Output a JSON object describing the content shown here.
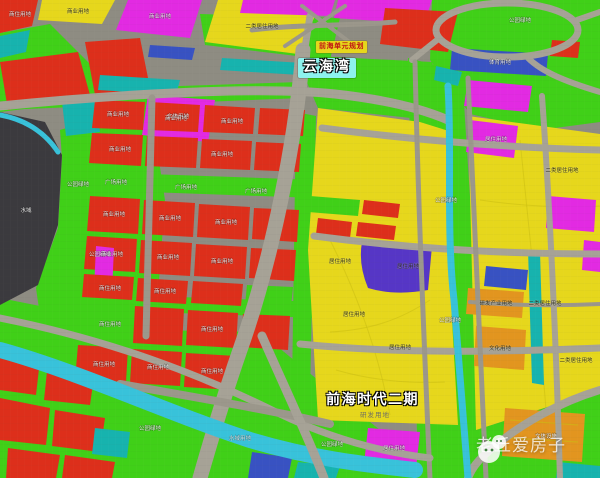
{
  "map": {
    "region": "前海片区规划示意图",
    "labels": {
      "planning_badge": "前海单元规划",
      "bay": "云海湾",
      "phase": "前海时代二期",
      "phase_sub": "研发用地"
    },
    "watermark": {
      "text": "老丘爱房子",
      "icon": "house-mascot-icon"
    },
    "colors": {
      "residential": "#e6d71c",
      "commercial": "#dd2f1b",
      "park": "#40d018",
      "mixed": "#e22ae2",
      "public": "#17b3ae",
      "civic": "#3852c2",
      "special": "#5636c6",
      "industry": "#e2951f",
      "river": "#38c2da",
      "sea": "#3b3a3e",
      "road": "#a6a296"
    },
    "zone_labels": [
      {
        "t": "商住用地",
        "x": 20,
        "y": 16,
        "c": "w"
      },
      {
        "t": "商业用地",
        "x": 78,
        "y": 13,
        "c": "k"
      },
      {
        "t": "商业用地",
        "x": 160,
        "y": 18,
        "c": "w"
      },
      {
        "t": "二类居住用地",
        "x": 262,
        "y": 28,
        "c": "k"
      },
      {
        "t": "文体用地",
        "x": 178,
        "y": 118,
        "c": "w"
      },
      {
        "t": "公园绿地",
        "x": 520,
        "y": 22,
        "c": "w"
      },
      {
        "t": "体育用地",
        "x": 500,
        "y": 64,
        "c": "w"
      },
      {
        "t": "公园绿地",
        "x": 78,
        "y": 186,
        "c": "w"
      },
      {
        "t": "公园绿地",
        "x": 100,
        "y": 256,
        "c": "w"
      },
      {
        "t": "水域",
        "x": 26,
        "y": 212,
        "c": "w"
      },
      {
        "t": "商业用地",
        "x": 118,
        "y": 116,
        "c": "w"
      },
      {
        "t": "商业用地",
        "x": 176,
        "y": 120,
        "c": "w"
      },
      {
        "t": "商业用地",
        "x": 232,
        "y": 123,
        "c": "w"
      },
      {
        "t": "商业用地",
        "x": 120,
        "y": 151,
        "c": "w"
      },
      {
        "t": "商业用地",
        "x": 222,
        "y": 156,
        "c": "w"
      },
      {
        "t": "广场用地",
        "x": 116,
        "y": 184,
        "c": "w"
      },
      {
        "t": "广场用地",
        "x": 186,
        "y": 189,
        "c": "w"
      },
      {
        "t": "广场用地",
        "x": 256,
        "y": 193,
        "c": "w"
      },
      {
        "t": "商业用地",
        "x": 114,
        "y": 216,
        "c": "w"
      },
      {
        "t": "商业用地",
        "x": 170,
        "y": 220,
        "c": "w"
      },
      {
        "t": "商业用地",
        "x": 226,
        "y": 224,
        "c": "w"
      },
      {
        "t": "商业用地",
        "x": 112,
        "y": 256,
        "c": "w"
      },
      {
        "t": "商业用地",
        "x": 168,
        "y": 259,
        "c": "w"
      },
      {
        "t": "商业用地",
        "x": 222,
        "y": 263,
        "c": "w"
      },
      {
        "t": "商住用地",
        "x": 110,
        "y": 290,
        "c": "w"
      },
      {
        "t": "商住用地",
        "x": 165,
        "y": 293,
        "c": "w"
      },
      {
        "t": "商住用地",
        "x": 110,
        "y": 326,
        "c": "w"
      },
      {
        "t": "商住用地",
        "x": 212,
        "y": 331,
        "c": "w"
      },
      {
        "t": "商住用地",
        "x": 104,
        "y": 366,
        "c": "w"
      },
      {
        "t": "商住用地",
        "x": 158,
        "y": 369,
        "c": "w"
      },
      {
        "t": "商住用地",
        "x": 212,
        "y": 373,
        "c": "w"
      },
      {
        "t": "居住用地",
        "x": 340,
        "y": 263,
        "c": "k"
      },
      {
        "t": "居住用地",
        "x": 408,
        "y": 268,
        "c": "k"
      },
      {
        "t": "居住用地",
        "x": 354,
        "y": 316,
        "c": "k"
      },
      {
        "t": "居住用地",
        "x": 400,
        "y": 349,
        "c": "k"
      },
      {
        "t": "居住用地",
        "x": 496,
        "y": 141,
        "c": "w"
      },
      {
        "t": "二类居住用地",
        "x": 562,
        "y": 172,
        "c": "k"
      },
      {
        "t": "研发产业用地",
        "x": 496,
        "y": 305,
        "c": "k"
      },
      {
        "t": "文化用地",
        "x": 500,
        "y": 350,
        "c": "k"
      },
      {
        "t": "二类居住用地",
        "x": 545,
        "y": 305,
        "c": "k"
      },
      {
        "t": "二类居住用地",
        "x": 576,
        "y": 362,
        "c": "k"
      },
      {
        "t": "公园绿地",
        "x": 446,
        "y": 202,
        "c": "w"
      },
      {
        "t": "公园绿地",
        "x": 450,
        "y": 322,
        "c": "w"
      },
      {
        "t": "公园绿地",
        "x": 150,
        "y": 430,
        "c": "w"
      },
      {
        "t": "公园绿地",
        "x": 332,
        "y": 446,
        "c": "w"
      },
      {
        "t": "水域用地",
        "x": 240,
        "y": 440,
        "c": "g"
      },
      {
        "t": "居住用地",
        "x": 394,
        "y": 450,
        "c": "w"
      },
      {
        "t": "文体设施",
        "x": 546,
        "y": 438,
        "c": "w"
      }
    ]
  }
}
